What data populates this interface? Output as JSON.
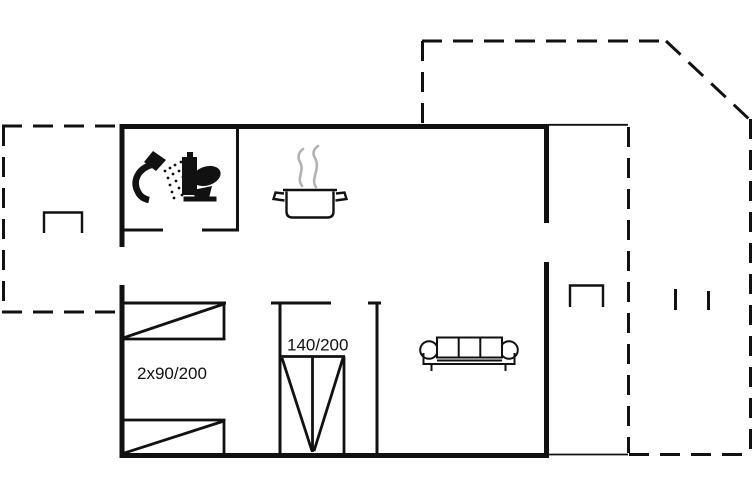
{
  "colors": {
    "line": "#111111",
    "steam": "#b3b3b3",
    "background": "#ffffff"
  },
  "labels": {
    "twin_beds": "2x90/200",
    "double_bed": "140/200"
  },
  "floor_plan": {
    "kind": "holiday-home floor plan",
    "rooms": [
      {
        "name": "bathroom",
        "icons": [
          "shower-icon",
          "toilet-icon"
        ]
      },
      {
        "name": "kitchen",
        "icons": [
          "steaming-pot-icon"
        ]
      },
      {
        "name": "bedroom",
        "furniture": [
          "single-bed",
          "single-bed"
        ],
        "size_label": "2x90/200"
      },
      {
        "name": "bed-alcove",
        "furniture": [
          "double-bed"
        ],
        "size_label": "140/200"
      },
      {
        "name": "living-room",
        "furniture": [
          "sofa"
        ]
      }
    ],
    "outdoor": [
      "terrace-left-dashed-outline",
      "terrace-right-dashed-outline"
    ]
  }
}
